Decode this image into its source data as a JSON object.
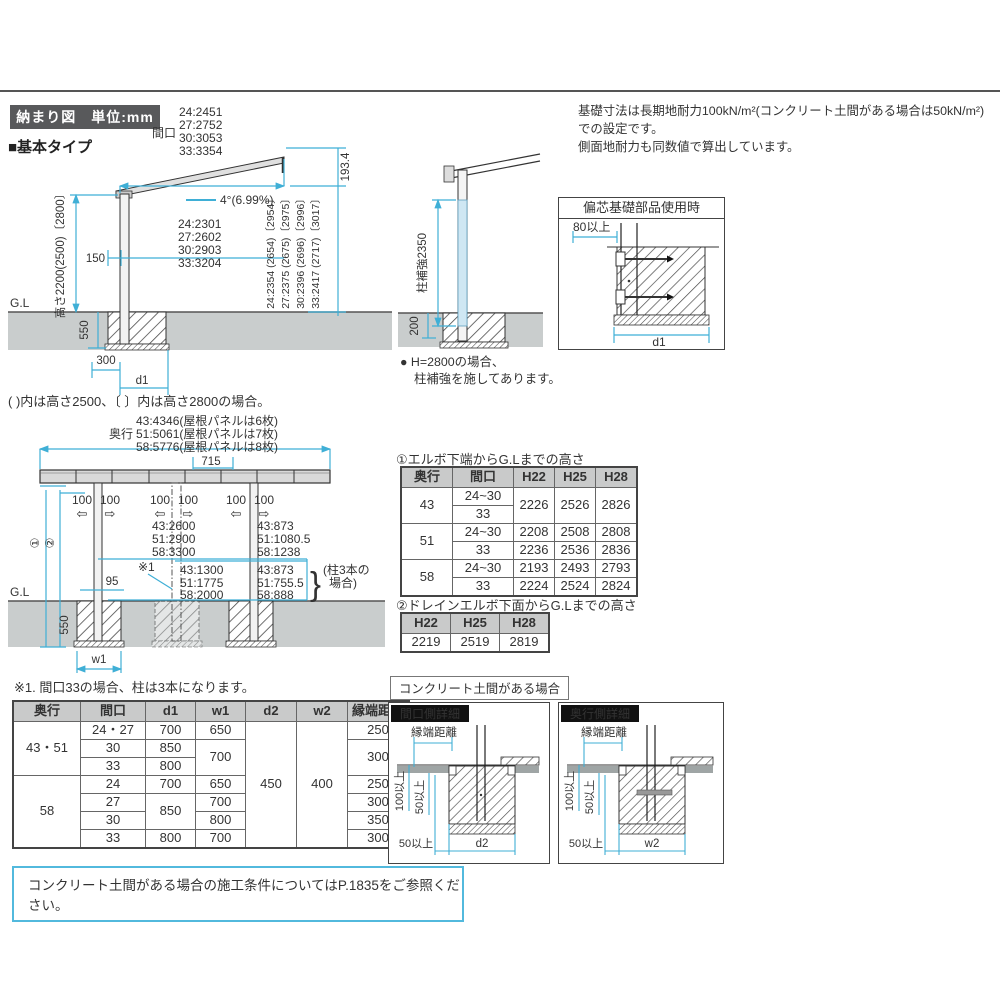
{
  "colors": {
    "accent": "#3fafd6",
    "ground": "#c9cdcd",
    "badge_bg": "#58595b",
    "table_header_bg": "#c9caca"
  },
  "labels": {
    "title_badge": "納まり図　単位:mm",
    "basic_type": "■基本タイプ",
    "top_note1": "基礎寸法は長期地耐力100kN/m²(コンクリート土間がある場合は50kN/m²)での設定です。",
    "top_note2": "側面地耐力も同数値で算出しています。",
    "parens_note": "( )内は高さ2500、〔 〕内は高さ2800の場合。",
    "h2800_note1": "● H=2800の場合、",
    "h2800_note2": "柱補強を施してあります。",
    "note1": "※1. 間口33の場合、柱は3本になります。",
    "concrete_case": "コンクリート土間がある場合",
    "bottom_note": "コンクリート土間がある場合の施工条件についてはP.1835をご参照ください。",
    "gl": "G.L"
  },
  "side": {
    "maguchi": "間口",
    "maguchi_vals": [
      "24:2451",
      "27:2752",
      "30:3053",
      "33:3354"
    ],
    "slope": "4°(6.99%)",
    "inner_vals": [
      "24:2301",
      "27:2602",
      "30:2903",
      "33:3204"
    ],
    "dim_193": "193.4",
    "right_vals": [
      "24:2354 (2654)〔2954〕",
      "27:2375 (2675)〔2975〕",
      "30:2396 (2696)〔2996〕",
      "33:2417 (2717)〔3017〕"
    ],
    "height": "高さ2200(2500)〔2800〕",
    "d150": "150",
    "d550": "550",
    "d300": "300",
    "dd1": "d1"
  },
  "col": {
    "reinforce": "柱補強2350",
    "d200": "200"
  },
  "ecc": {
    "title": "偏芯基礎部品使用時",
    "d80": "80以上",
    "dd1": "d1"
  },
  "front": {
    "okuyuki": "奥行",
    "okuyuki_vals": [
      "43:4346(屋根パネルは6枚)",
      "51:5061(屋根パネルは7枚)",
      "58:5776(屋根パネルは8枚)"
    ],
    "d715": "715",
    "d100": "100",
    "arrow_l": "⇦",
    "arrow_r": "⇨",
    "upper_center": [
      "43:2600",
      "51:2900",
      "58:3300"
    ],
    "upper_right": [
      "43:873",
      "51:1080.5",
      "58:1238"
    ],
    "lower_center": [
      "43:1300",
      "51:1775",
      "58:2000"
    ],
    "lower_right": [
      "43:873",
      "51:755.5",
      "58:888"
    ],
    "brace": "}",
    "three_post1": "(柱3本の",
    "three_post2": "場合)",
    "d95": "95",
    "ref1": "※1",
    "d550": "550",
    "dw1": "w1",
    "c1": "①",
    "c2": "②"
  },
  "t1": {
    "title": "①エルボ下端からG.Lまでの高さ",
    "headers": [
      "奥行",
      "間口",
      "H22",
      "H25",
      "H28"
    ],
    "rows": [
      [
        "43",
        "24~30",
        "2226",
        "2526",
        "2826"
      ],
      [
        "33"
      ],
      [
        "51",
        "24~30",
        "2208",
        "2508",
        "2808"
      ],
      [
        "33",
        "2236",
        "2536",
        "2836"
      ],
      [
        "58",
        "24~30",
        "2193",
        "2493",
        "2793"
      ],
      [
        "33",
        "2224",
        "2524",
        "2824"
      ]
    ]
  },
  "t2": {
    "title": "②ドレインエルボ下面からG.Lまでの高さ",
    "headers": [
      "H22",
      "H25",
      "H28"
    ],
    "values": [
      "2219",
      "2519",
      "2819"
    ]
  },
  "spec": {
    "headers": [
      "奥行",
      "間口",
      "d1",
      "w1",
      "d2",
      "w2",
      "縁端距離"
    ],
    "rows": [
      [
        "43・51",
        "24・27",
        "700",
        "650",
        "450",
        "400",
        "250"
      ],
      [
        "30",
        "850",
        "700",
        "300"
      ],
      [
        "33",
        "800"
      ],
      [
        "58",
        "24",
        "700",
        "650",
        "250"
      ],
      [
        "27",
        "850",
        "700",
        "300"
      ],
      [
        "30",
        "800",
        "350"
      ],
      [
        "33",
        "800",
        "700",
        "300"
      ]
    ]
  },
  "detail": {
    "maguchi_title": "間口側詳細",
    "okuyuki_title": "奥行側詳細",
    "edge": "縁端距離",
    "d100": "100以上",
    "d50": "50以上",
    "dd2": "d2",
    "dw2": "w2"
  }
}
